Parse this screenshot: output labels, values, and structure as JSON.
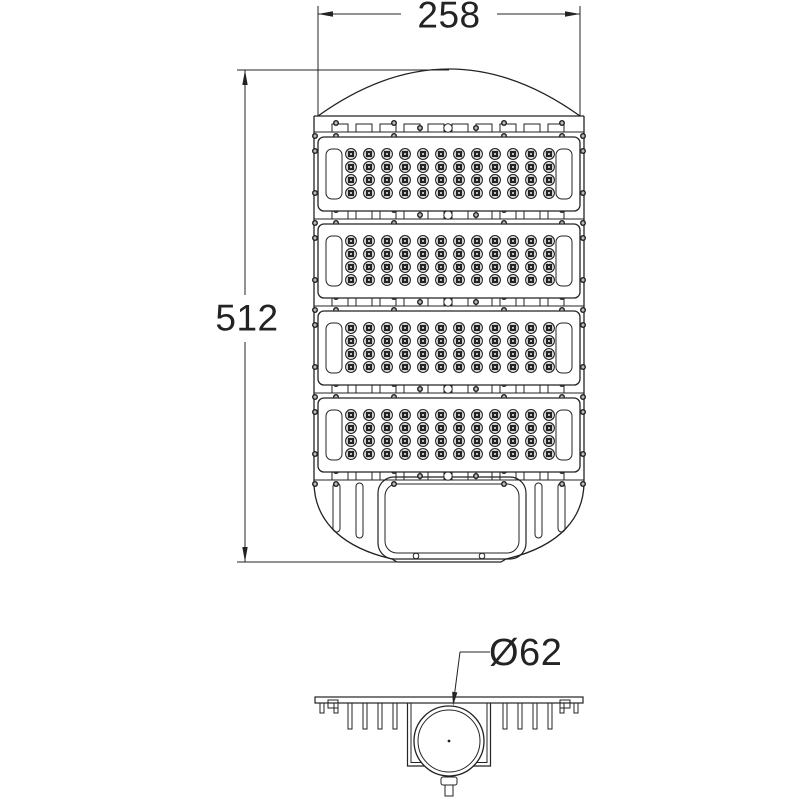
{
  "drawing": {
    "background": "#ffffff",
    "line_color": "#232323",
    "dimensions": {
      "width": {
        "label": "258"
      },
      "height": {
        "label": "512"
      },
      "mount_diameter": {
        "label": "Ø62"
      }
    },
    "top_view": {
      "led_modules": 4,
      "led_rows_per_module": 4,
      "led_columns_per_module": 12,
      "mounting_strips": 5,
      "tabs_per_strip": 10,
      "vent_slots": 4,
      "cover_screw_holes": 2
    },
    "section_view": {
      "stub_fins_per_side": 2,
      "long_fins_per_side": 4
    }
  }
}
